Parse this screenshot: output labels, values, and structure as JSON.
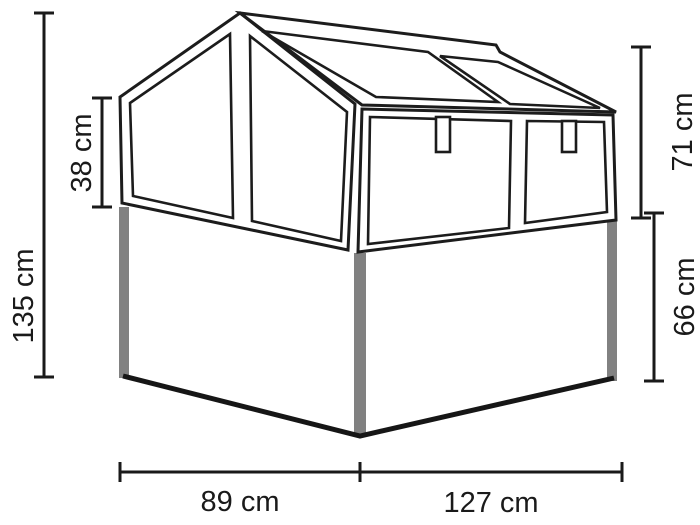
{
  "page": {
    "background": "#ffffff"
  },
  "diagram": {
    "type": "product-dimension-diagram",
    "subject": "cold-frame greenhouse on raised base",
    "colors": {
      "line": "#1c1c1c",
      "legs": "#818181",
      "background": "#ffffff"
    },
    "dimensions": {
      "total_height": {
        "value": 135,
        "unit": "cm",
        "label": "135 cm"
      },
      "gable_front_edge_height": {
        "value": 38,
        "unit": "cm",
        "label": "38 cm"
      },
      "glass_top_height": {
        "value": 71,
        "unit": "cm",
        "label": "71 cm"
      },
      "base_height": {
        "value": 66,
        "unit": "cm",
        "label": "66 cm"
      },
      "side_depth": {
        "value": 89,
        "unit": "cm",
        "label": "89 cm"
      },
      "front_width": {
        "value": 127,
        "unit": "cm",
        "label": "127 cm"
      }
    }
  }
}
